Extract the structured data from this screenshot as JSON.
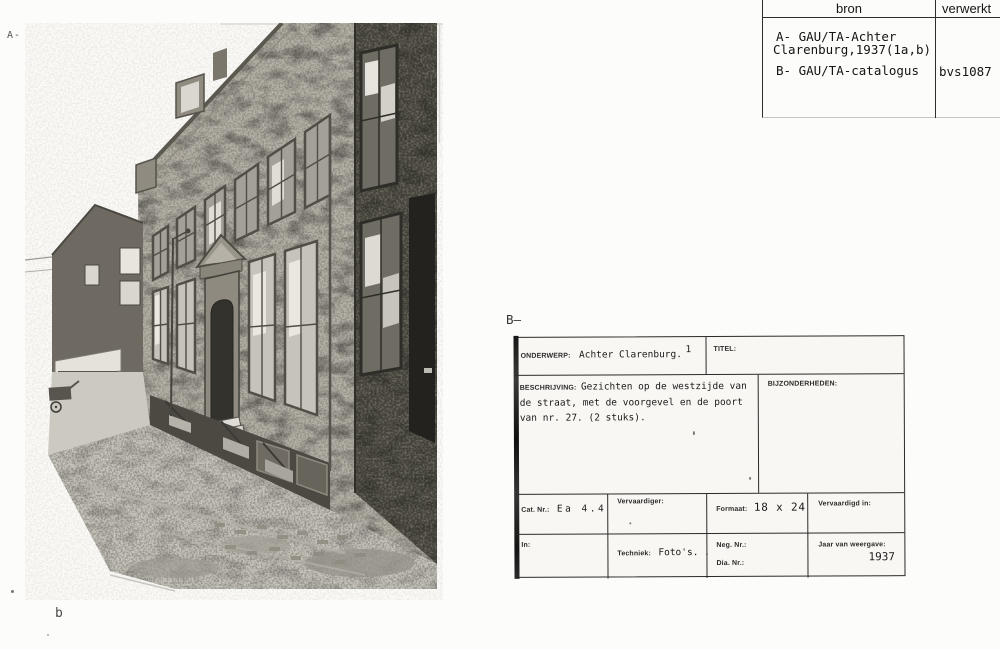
{
  "page": {
    "photo_label_a": "A-",
    "photo_caption_b": "b",
    "card_section_label": "B—"
  },
  "bron_table": {
    "header_bron": "bron",
    "header_verwerkt": "verwerkt",
    "entry_a_line1": "A- GAU/TA-Achter",
    "entry_a_line2": "Clarenburg,1937(1a,b)",
    "entry_b": "B- GAU/TA-catalogus",
    "verwerkt_value": "bvs1087"
  },
  "catalog_card": {
    "onderwerp_label": "ONDERWERP:",
    "onderwerp_value": "Achter Clarenburg.",
    "onderwerp_number": "1",
    "titel_label": "TITEL:",
    "beschrijving_label": "BESCHRIJVING:",
    "beschrijving_value": "Gezichten op de westzijde van de straat, met de voorgevel en de poort van nr. 27. (2 stuks).",
    "bijzonderheden_label": "BIJZONDERHEDEN:",
    "cat_nr_label": "Cat. Nr.:",
    "cat_nr_value": "Ea 4.4",
    "vervaardiger_label": "Vervaardiger:",
    "formaat_label": "Formaat:",
    "formaat_value": "18 x 24",
    "vervaardigd_in_label": "Vervaardigd in:",
    "in_label": "In:",
    "techniek_label": "Techniek:",
    "techniek_value": "Foto's. .",
    "neg_nr_label": "Neg. Nr.:",
    "dia_nr_label": "Dia. Nr.:",
    "jaar_label": "Jaar van weergave:",
    "jaar_value": "1937"
  }
}
